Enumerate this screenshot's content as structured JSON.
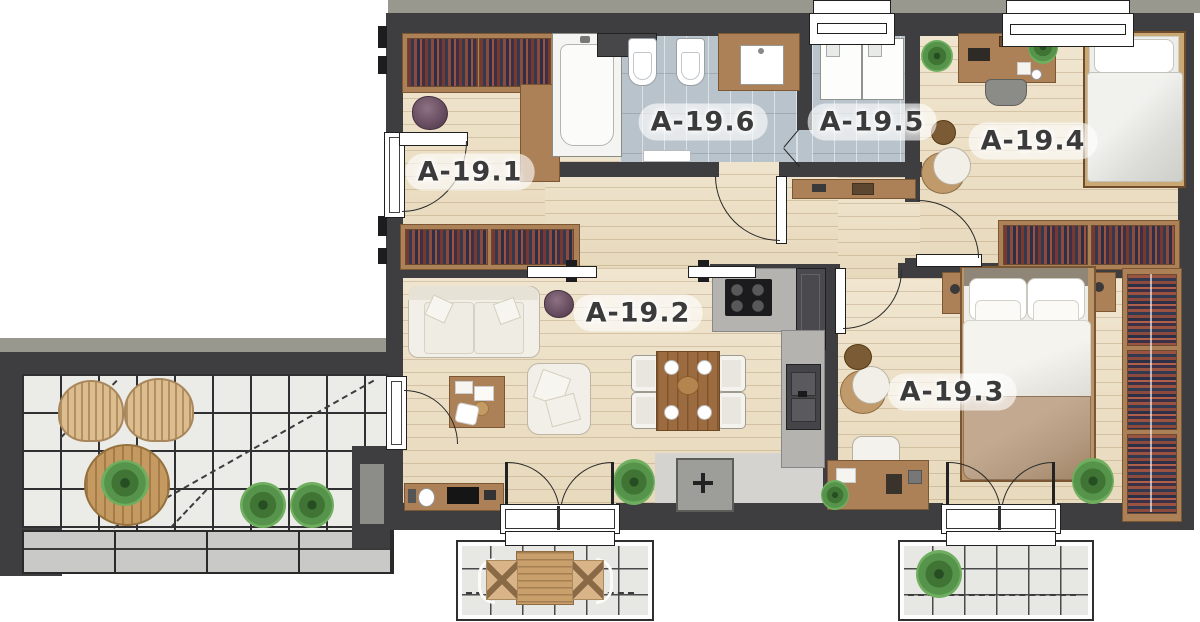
{
  "plan": {
    "type": "apartment-floor-plan",
    "rooms": [
      {
        "id": "a-19-1",
        "label": "A-19.1"
      },
      {
        "id": "a-19-2",
        "label": "A-19.2"
      },
      {
        "id": "a-19-3",
        "label": "A-19.3"
      },
      {
        "id": "a-19-4",
        "label": "A-19.4"
      },
      {
        "id": "a-19-5",
        "label": "A-19.5"
      },
      {
        "id": "a-19-6",
        "label": "A-19.6"
      }
    ],
    "colors": {
      "wall": "#3e3e40",
      "wood_floor": "#ecdfc7",
      "bath_tile": "#b9c3cb",
      "balcony_tile": "#ebebe8",
      "counter": "#b4b3af",
      "furniture_wood": "#ad8157",
      "plant": "#55944a",
      "blanket": "#b49a80",
      "label_text": "#3b3b3b"
    }
  }
}
